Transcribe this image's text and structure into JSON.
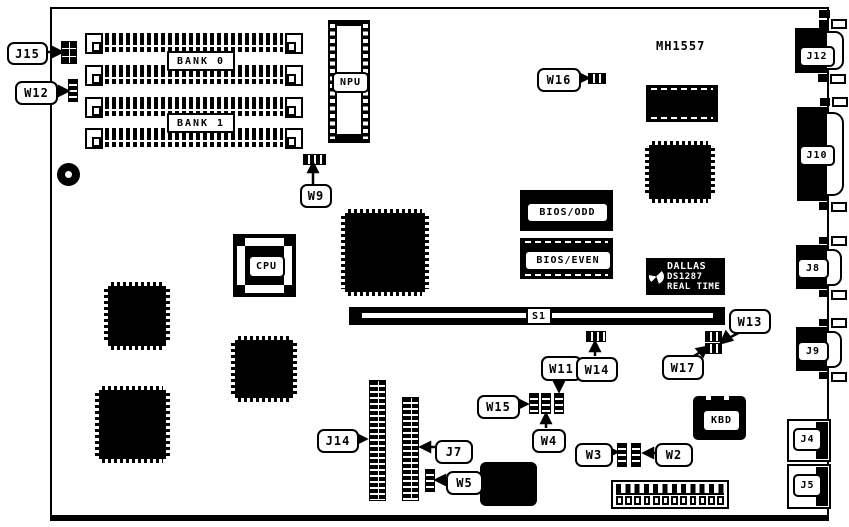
{
  "board": {
    "part_number": "MH1557",
    "memory": {
      "bank0": "BANK 0",
      "bank1": "BANK 1"
    },
    "sockets": {
      "npu": "NPU",
      "cpu": "CPU",
      "kbd": "KBD",
      "slot": "S1"
    },
    "bios": {
      "odd": "BIOS/ODD",
      "even": "BIOS/EVEN"
    },
    "rtc": {
      "brand": "DALLAS",
      "model": "DS1287",
      "caption": "REAL TIME"
    },
    "jumpers": {
      "w2": "W2",
      "w3": "W3",
      "w4": "W4",
      "w5": "W5",
      "w9": "W9",
      "w11": "W11",
      "w12": "W12",
      "w13": "W13",
      "w14": "W14",
      "w15": "W15",
      "w16": "W16",
      "w17": "W17"
    },
    "connectors": {
      "j4": "J4",
      "j5": "J5",
      "j7": "J7",
      "j8": "J8",
      "j9": "J9",
      "j10": "J10",
      "j12": "J12",
      "j14": "J14",
      "j15": "J15"
    },
    "colors": {
      "ink": "#000000",
      "paper": "#ffffff"
    }
  }
}
